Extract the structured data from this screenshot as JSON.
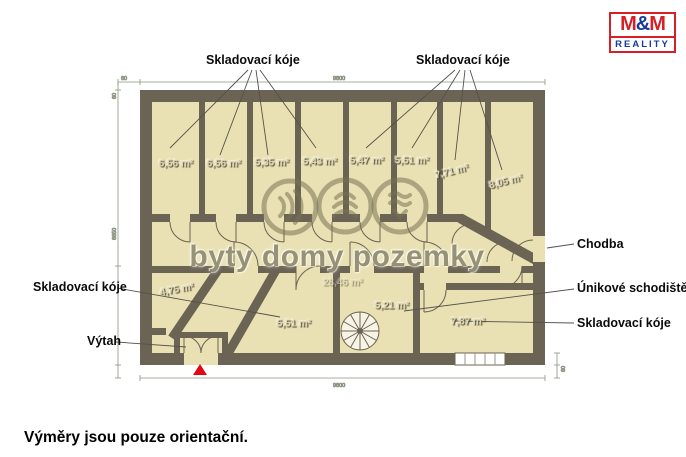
{
  "header": {
    "logo": {
      "m1": "M",
      "amp": "&",
      "m2": "M",
      "bottom": "REALITY"
    }
  },
  "plan": {
    "labels": {
      "storage_top_left": "Skladovací kóje",
      "storage_top_right": "Skladovací kóje",
      "storage_left": "Skladovací kóje",
      "storage_right": "Skladovací kóje",
      "corridor": "Chodba",
      "escape_stairs": "Únikové schodiště",
      "elevator": "Výtah"
    },
    "storage_rooms": [
      {
        "area": "6,56 m²"
      },
      {
        "area": "6,56 m²"
      },
      {
        "area": "5,35 m²"
      },
      {
        "area": "5,43 m²"
      },
      {
        "area": "5,47 m²"
      },
      {
        "area": "5,51 m²"
      },
      {
        "area": "7,71 m²"
      },
      {
        "area": "8,05 m²"
      },
      {
        "area": "4,75 m²"
      },
      {
        "area": "5,51 m²"
      },
      {
        "area": "5,21 m²"
      },
      {
        "area": "7,87 m²"
      }
    ],
    "corridor_area": "28,46 m²",
    "dimensions": {
      "top_offset": "60",
      "top_width": "9800",
      "left_offset": "60",
      "left_height": "6650",
      "bottom_width": "9800",
      "right_offset": "60"
    }
  },
  "watermark": {
    "text": "byty domy pozemky"
  },
  "footer": {
    "disclaimer": "Výměry jsou pouze orientační."
  },
  "colors": {
    "wall": "#6b6353",
    "room_fill": "#e9e1b3",
    "background": "#ffffff",
    "entrance_marker_red": "#e30613",
    "logo_red": "#d61f26",
    "logo_blue": "#16399b",
    "dimension_line": "#8a9480",
    "watermark_olive": "#857f5e"
  }
}
